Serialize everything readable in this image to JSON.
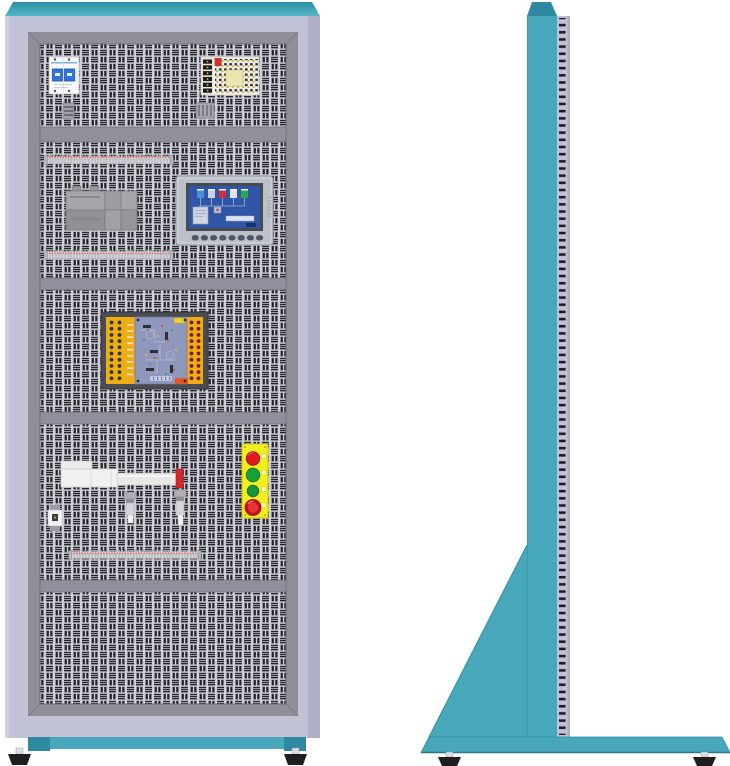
{
  "figure": {
    "type": "technical-illustration",
    "subject": "electrical-control-training-cabinet",
    "views": [
      "front",
      "side"
    ]
  },
  "palette": {
    "background": "#ffffff",
    "cabinet_teal": "#49a7bb",
    "cabinet_teal_dark": "#2d8aa1",
    "frame_lavender": "#c2c2d6",
    "panel_frame_gray": "#8f8f97",
    "divider_gray": "#90909a",
    "perforation_light": "#cfcfd8",
    "perforation_dark": "#26262c",
    "plc_orange": "#f0ac17",
    "pcb_blue_gray": "#8f98bc",
    "hmi_screen_blue": "#3156a8",
    "button_plate_yellow": "#f2ee20",
    "button_red": "#df1a20",
    "button_green": "#17a038",
    "estop_red": "#c61219",
    "rail_pink": "#d66a6a",
    "cylinder_tip_red": "#d8262c",
    "foot_black": "#1e1e22"
  },
  "front_view": {
    "sections": [
      {
        "row": 1,
        "components": [
          "circuit-breaker",
          "din-clamp",
          "switching-power-supply",
          "din-clamp"
        ]
      },
      {
        "row": 2,
        "components": [
          "terminal-rail",
          "contactor-group",
          "hmi-touch-panel",
          "terminal-rail"
        ]
      },
      {
        "row": 3,
        "components": [
          "plc-io-training-board"
        ]
      },
      {
        "row": 4,
        "components": [
          "pneumatic-cylinder",
          "micro-relay",
          "proximity-sensor",
          "proximity-sensor",
          "pushbutton-station",
          "terminal-rail"
        ]
      },
      {
        "row": 5,
        "components": []
      }
    ],
    "hmi": {
      "brand_text": "TOUCH",
      "screen_tanks": [
        "blue",
        "gray",
        "red",
        "white",
        "green"
      ],
      "function_keys": 8
    },
    "button_station": {
      "buttons": [
        "red",
        "green",
        "green",
        "emergency-stop"
      ]
    },
    "plc_board": {
      "left_terminal_rows": 10,
      "right_terminal_rows": 10
    },
    "feet": 2
  },
  "side_view": {
    "parts": [
      "column",
      "perforated-panel-edge",
      "support-gusset",
      "base-plate"
    ],
    "feet": 2
  }
}
